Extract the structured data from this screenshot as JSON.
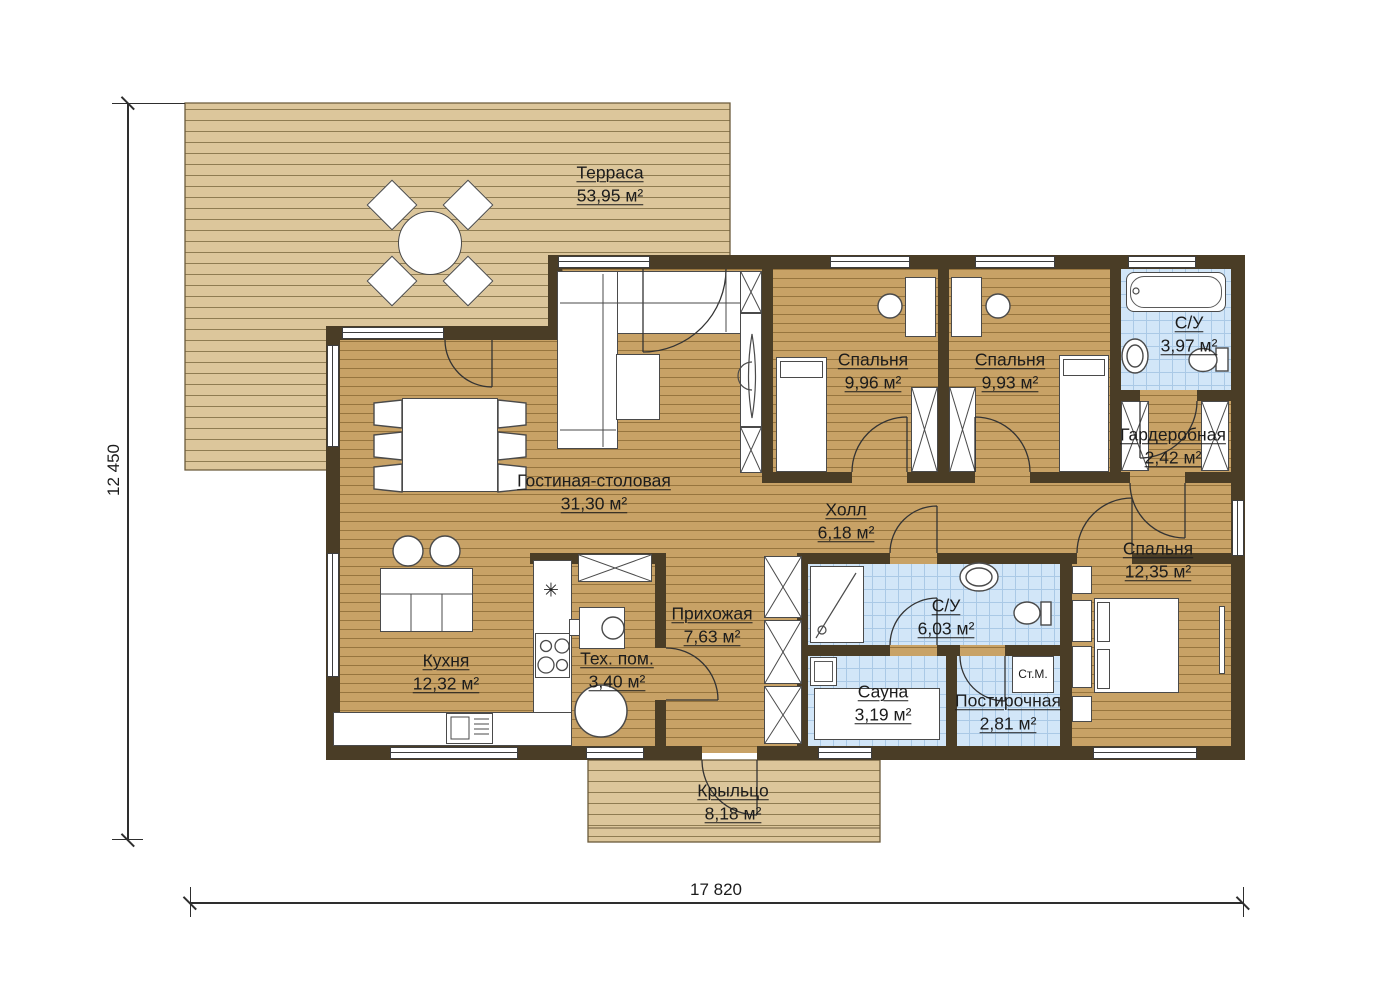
{
  "rooms": [
    {
      "id": "terrace",
      "name": "Терраса",
      "area": "53,95 м²"
    },
    {
      "id": "living",
      "name": "Гостиная-столовая",
      "area": "31,30 м²"
    },
    {
      "id": "kitchen",
      "name": "Кухня",
      "area": "12,32 м²"
    },
    {
      "id": "tech",
      "name": "Тех. пом.",
      "area": "3,40 м²"
    },
    {
      "id": "entry",
      "name": "Прихожая",
      "area": "7,63 м²"
    },
    {
      "id": "hall",
      "name": "Холл",
      "area": "6,18 м²"
    },
    {
      "id": "bedroom1",
      "name": "Спальня",
      "area": "9,96 м²"
    },
    {
      "id": "bedroom2",
      "name": "Спальня",
      "area": "9,93 м²"
    },
    {
      "id": "bathroom1",
      "name": "С/У",
      "area": "3,97 м²"
    },
    {
      "id": "wardrobe",
      "name": "Гардеробная",
      "area": "2,42 м²"
    },
    {
      "id": "bedroom3",
      "name": "Спальня",
      "area": "12,35 м²"
    },
    {
      "id": "bathroom2",
      "name": "С/У",
      "area": "6,03 м²"
    },
    {
      "id": "sauna",
      "name": "Сауна",
      "area": "3,19 м²"
    },
    {
      "id": "laundry",
      "name": "Постирочная",
      "area": "2,81 м²"
    },
    {
      "id": "porch",
      "name": "Крыльцо",
      "area": "8,18 м²"
    }
  ],
  "labels": {
    "washing_machine": "Ст.М."
  },
  "dimensions": {
    "horizontal": "17 820",
    "vertical": "12 450"
  },
  "icons": {
    "kitchen_star": "✳"
  },
  "colors": {
    "wall": "#4a3d26",
    "deck": "#dcc69b",
    "deck_line": "#8f7c52",
    "wood": "#c8a266",
    "wood_line": "#97753e",
    "tile": "#d2e6f8",
    "tile_line": "#aac9e6",
    "text": "#1c1c1c"
  }
}
